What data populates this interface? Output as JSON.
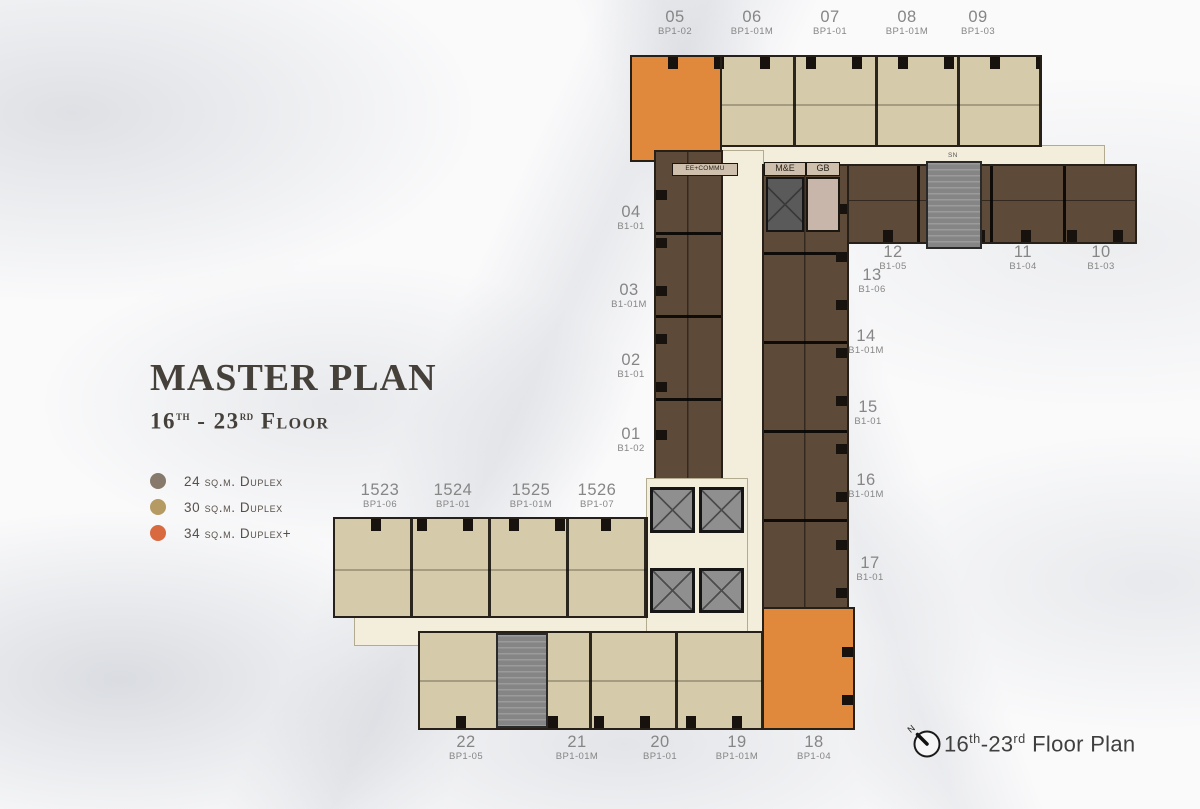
{
  "colors": {
    "beige": "#d5caa9",
    "brown": "#5d4a39",
    "orange": "#e0883b",
    "corridor": "#f3eedb",
    "stair": "#858585",
    "label": "#868686",
    "title": "#45403a",
    "legend_gray": "#87796b",
    "legend_tan": "#b59a63",
    "legend_orange": "#d9693f"
  },
  "title": {
    "main": "MASTER PLAN",
    "floor_parts": [
      {
        "t": "16"
      },
      {
        "t": "th",
        "sup": true
      },
      {
        "t": " - 23"
      },
      {
        "t": "rd",
        "sup": true
      },
      {
        "t": " Floor"
      }
    ]
  },
  "legend": {
    "items": [
      {
        "label": "24 sq.m. Duplex",
        "color_key": "legend_gray"
      },
      {
        "label": "30 sq.m. Duplex",
        "color_key": "legend_tan"
      },
      {
        "label": "34 sq.m. Duplex+",
        "color_key": "legend_orange"
      }
    ]
  },
  "plan": {
    "unit_labels": [
      {
        "no": "05",
        "type": "BP1-02",
        "x": 675,
        "y": 8
      },
      {
        "no": "06",
        "type": "BP1-01M",
        "x": 752,
        "y": 8
      },
      {
        "no": "07",
        "type": "BP1-01",
        "x": 830,
        "y": 8
      },
      {
        "no": "08",
        "type": "BP1-01M",
        "x": 907,
        "y": 8
      },
      {
        "no": "09",
        "type": "BP1-03",
        "x": 978,
        "y": 8
      },
      {
        "no": "12",
        "type": "B1-05",
        "x": 893,
        "y": 243
      },
      {
        "no": "11",
        "type": "B1-04",
        "x": 1023,
        "y": 243
      },
      {
        "no": "10",
        "type": "B1-03",
        "x": 1101,
        "y": 243
      },
      {
        "no": "13",
        "type": "B1-06",
        "x": 872,
        "y": 266
      },
      {
        "no": "04",
        "type": "B1-01",
        "x": 631,
        "y": 203
      },
      {
        "no": "03",
        "type": "B1-01M",
        "x": 629,
        "y": 281
      },
      {
        "no": "02",
        "type": "B1-01",
        "x": 631,
        "y": 351
      },
      {
        "no": "01",
        "type": "B1-02",
        "x": 631,
        "y": 425
      },
      {
        "no": "14",
        "type": "B1-01M",
        "x": 866,
        "y": 327
      },
      {
        "no": "15",
        "type": "B1-01",
        "x": 868,
        "y": 398
      },
      {
        "no": "16",
        "type": "B1-01M",
        "x": 866,
        "y": 471
      },
      {
        "no": "17",
        "type": "B1-01",
        "x": 870,
        "y": 554
      },
      {
        "no": "1523",
        "type": "BP1-06",
        "x": 380,
        "y": 481
      },
      {
        "no": "1524",
        "type": "BP1-01",
        "x": 453,
        "y": 481
      },
      {
        "no": "1525",
        "type": "BP1-01M",
        "x": 531,
        "y": 481
      },
      {
        "no": "1526",
        "type": "BP1-07",
        "x": 597,
        "y": 481
      },
      {
        "no": "22",
        "type": "BP1-05",
        "x": 466,
        "y": 733
      },
      {
        "no": "21",
        "type": "BP1-01M",
        "x": 577,
        "y": 733
      },
      {
        "no": "20",
        "type": "BP1-01",
        "x": 660,
        "y": 733
      },
      {
        "no": "19",
        "type": "BP1-01M",
        "x": 737,
        "y": 733
      },
      {
        "no": "18",
        "type": "BP1-04",
        "x": 814,
        "y": 733
      }
    ],
    "room_labels": {
      "me": "M&E",
      "gb": "GB",
      "ee": "EE+COMMU",
      "sn": "SN"
    }
  },
  "footer": {
    "compass_n": "N",
    "caption_parts": [
      {
        "t": "16"
      },
      {
        "t": "th",
        "sup": true
      },
      {
        "t": "-23"
      },
      {
        "t": "rd",
        "sup": true
      },
      {
        "t": " Floor Plan"
      }
    ]
  }
}
